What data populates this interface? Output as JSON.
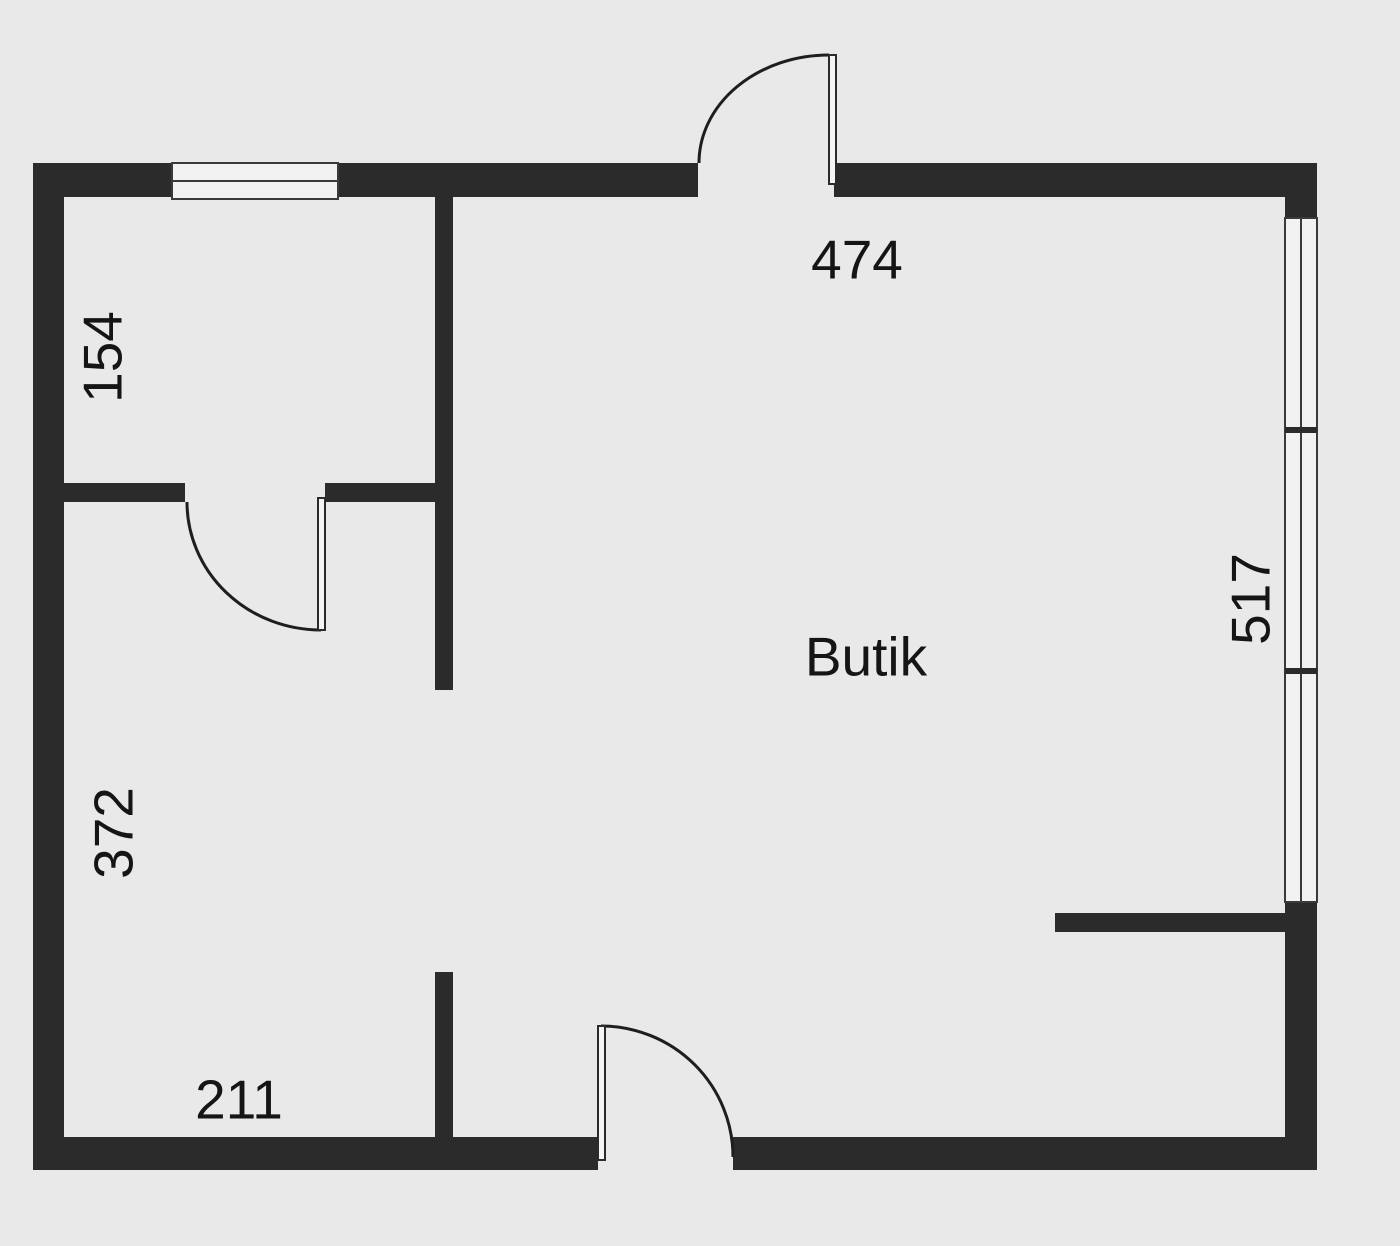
{
  "plan": {
    "room_label": "Butik",
    "dimension_labels": {
      "top": "474",
      "upper_left_room": "154",
      "left": "372",
      "right": "517",
      "bottom": "211"
    },
    "colors": {
      "background": "#e9e9e9",
      "wall": "#2b2b2b",
      "window_glass": "#f2f2f2",
      "line": "#3a3a3a",
      "text": "#151515"
    }
  }
}
